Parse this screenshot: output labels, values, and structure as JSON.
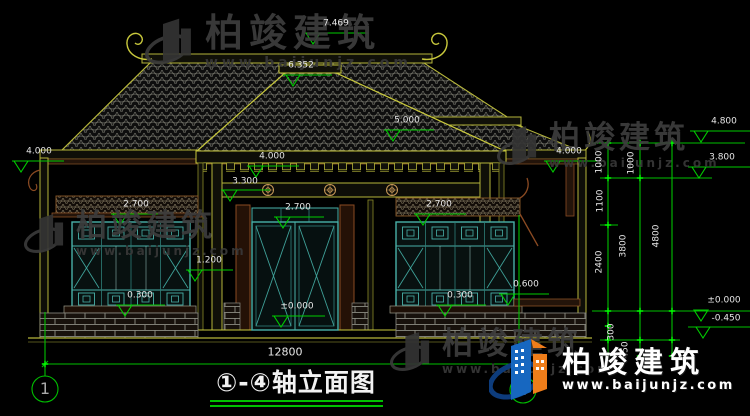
{
  "title": {
    "text": "①-④轴立面图"
  },
  "axes": {
    "left": "1",
    "right": "4"
  },
  "dims": {
    "total_width": "12800",
    "r1000a": "1000",
    "r1000b": "1000",
    "r1100": "1100",
    "r2400": "2400",
    "r3800": "3800",
    "r4800": "4800",
    "r300": "300",
    "r450": "450"
  },
  "levels": {
    "main_ridge": "7.469",
    "porch_ridge": "6.352",
    "left_eave": "4.000",
    "wing_ridge": "5.000",
    "right_eave": "4.000",
    "porch_beam": "4.000",
    "porch_lintel": "3.300",
    "left_window_head": "2.700",
    "door_head": "2.700",
    "right_window_head": "2.700",
    "porch_mid": "1.200",
    "left_sill": "0.300",
    "right_sill": "0.300",
    "right_ledge": "0.600",
    "floor": "±0.000",
    "datum_right": "±0.000",
    "ground_right": "-0.450",
    "level_480": "4.800",
    "level_380": "3.800"
  },
  "watermark": {
    "brand": "柏竣建筑",
    "url": "www.baijunjz.com"
  },
  "logo": {
    "brand": "柏竣建筑",
    "url": "www.baijunjz.com"
  }
}
